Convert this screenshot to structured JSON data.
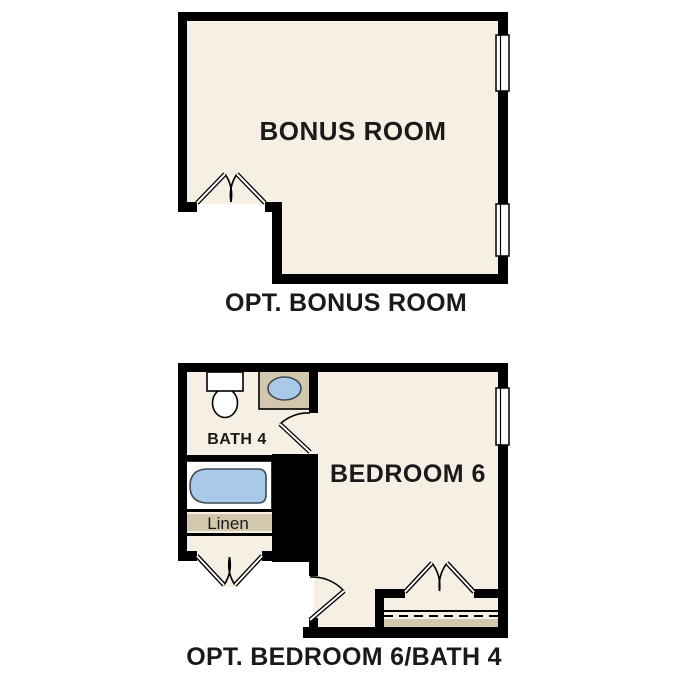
{
  "colors": {
    "wall": "#000000",
    "floor": "#f6efe3",
    "counter_tan": "#d3c8ad",
    "water_blue": "#a9c9e8",
    "fixture_white": "#ffffff",
    "label": "#1a1a1a"
  },
  "bonus_plan": {
    "room_label": "BONUS ROOM",
    "caption": "OPT. BONUS ROOM"
  },
  "bedroom_plan": {
    "bedroom_label": "BEDROOM 6",
    "bath_label": "BATH 4",
    "linen_label": "Linen",
    "caption": "OPT. BEDROOM 6/BATH 4"
  }
}
